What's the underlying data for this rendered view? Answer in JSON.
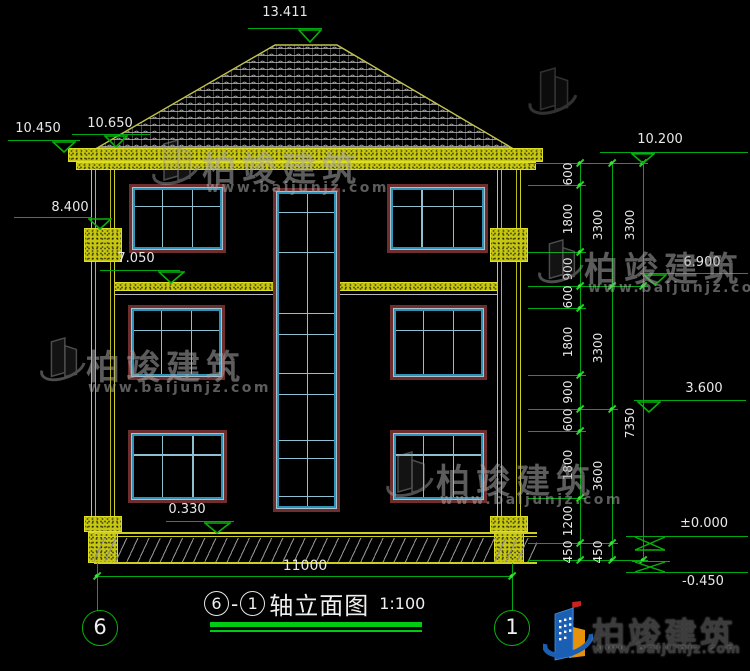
{
  "title": {
    "axis_start": "6",
    "separator": "-",
    "axis_end": "1",
    "name": "轴立面图",
    "scale": "1:100"
  },
  "elevation_markers": {
    "ridge": "13.411",
    "eave_outer_left": "10.450",
    "eave_inner_left": "10.650",
    "column_capital": "8.400",
    "floor_band": "7.050",
    "window_sill": "0.330",
    "eave_right": "10.200",
    "level_3": "6.900",
    "level_2": "3.600",
    "ground_zero": "±0.000",
    "site_ground": "-0.450"
  },
  "dimensions": {
    "bottom_total": "11000",
    "right_inner": [
      "600",
      "1800",
      "900",
      "600",
      "1800",
      "900",
      "600",
      "1800",
      "1200",
      "450"
    ],
    "right_middle": [
      "3300",
      "3300",
      "3600",
      "450"
    ],
    "right_outer": [
      "3300",
      "7350"
    ]
  },
  "axis_bubbles": {
    "left": "6",
    "right": "1"
  },
  "watermark": {
    "brand": "柏竣建筑",
    "url": "www.baijunjz.com"
  },
  "logo": {
    "brand": "柏竣建筑",
    "url": "www.baijunjz.com"
  },
  "colors": {
    "line_green": "#00a812",
    "cad_yellow": "#cfcf1d",
    "window_frame": "#6e2e2e",
    "window_sash": "#2e93b8",
    "logo_blue": "#1a5fb4",
    "logo_orange": "#e8920a"
  }
}
